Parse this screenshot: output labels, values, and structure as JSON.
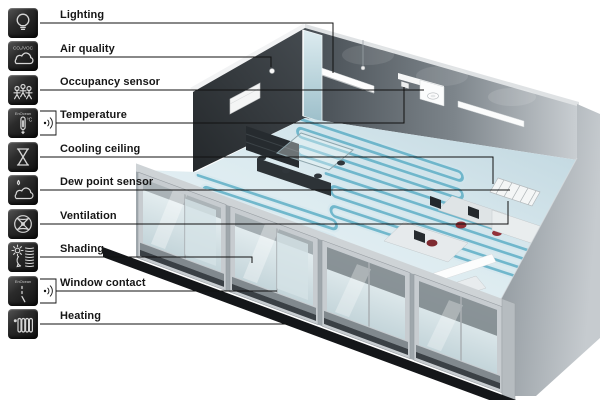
{
  "figure_title": "Room automation functions cutaway",
  "sidebar": {
    "tile_color": "#1d1d1d",
    "icon_stroke": "#d6d6d6",
    "items": [
      {
        "label": "Lighting",
        "icon": "lightbulb-icon"
      },
      {
        "label": "Air quality",
        "icon": "air-quality-cloud-icon",
        "icon_text": "CO₂/VOC"
      },
      {
        "label": "Occupancy sensor",
        "icon": "occupancy-people-icon"
      },
      {
        "label": "Temperature",
        "icon": "thermometer-icon",
        "icon_text": "EnOcean",
        "icon_unit": "°C",
        "wireless": true
      },
      {
        "label": "Cooling ceiling",
        "icon": "hourglass-icon"
      },
      {
        "label": "Dew point sensor",
        "icon": "dew-cloud-icon"
      },
      {
        "label": "Ventilation",
        "icon": "fan-icon"
      },
      {
        "label": "Shading",
        "icon": "sun-blinds-icon"
      },
      {
        "label": "Window contact",
        "icon": "window-contact-icon",
        "icon_text": "EnOcean",
        "wireless": true
      },
      {
        "label": "Heating",
        "icon": "radiator-icon"
      }
    ]
  },
  "scene": {
    "description": "3D cutaway of an open-plan office with chilled-ceiling coils, glass facade and automation sensors",
    "colors": {
      "coil": "#4fa7c0",
      "floor": "#dcebf0",
      "wall_dark": "#2f353a",
      "wall_light": "#c9ced2",
      "concrete": "#a8afb4",
      "facade_frame": "#c7ccd0",
      "base_band": "#141619",
      "chair_accent": "#8e2f36",
      "callout_line": "#111111"
    }
  }
}
